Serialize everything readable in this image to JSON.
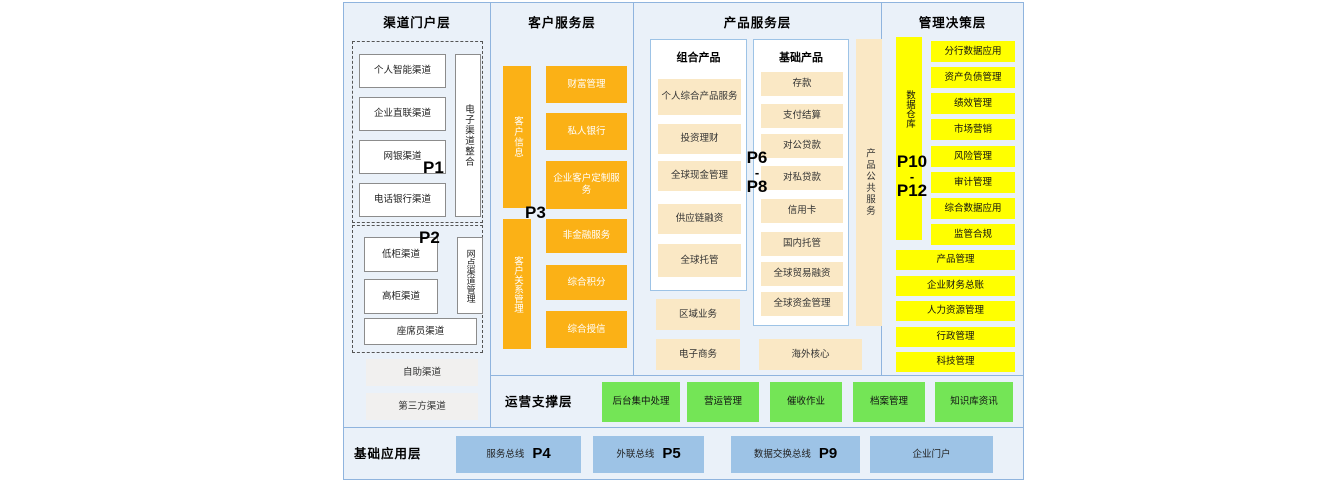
{
  "colors": {
    "panel_bg": "#EAF1F9",
    "border_blue": "#8FB4DE",
    "orange": "#FBB116",
    "cream": "#FAE8C5",
    "yellow": "#FFFF00",
    "green": "#74E556",
    "blue": "#9DC3E6"
  },
  "channel": {
    "title": "渠道门户层",
    "p1": "P1",
    "p2": "P2",
    "group1": [
      "个人智能渠道",
      "企业直联渠道",
      "网银渠道",
      "电话银行渠道"
    ],
    "group1_vertical": "电子渠道整合",
    "group2": [
      "低柜渠道",
      "高柜渠道"
    ],
    "group2_vertical": "网点渠道管理",
    "group2_wide": "座席员渠道",
    "extras": [
      "自助渠道",
      "第三方渠道"
    ]
  },
  "customer": {
    "title": "客户服务层",
    "p3": "P3",
    "upper_vertical": "客户信息",
    "upper": [
      "财富管理",
      "私人银行",
      "企业客户定制服务"
    ],
    "lower_vertical": "客户关系管理",
    "lower": [
      "非金融服务",
      "综合积分",
      "综合授信"
    ]
  },
  "product": {
    "title": "产品服务层",
    "p_top": "P6",
    "p_sep": "-",
    "p_bottom": "P8",
    "combo_title": "组合产品",
    "combo": [
      "个人综合产品服务",
      "投资理财",
      "全球现金管理",
      "供应链融资",
      "全球托管"
    ],
    "basic_title": "基础产品",
    "basic": [
      "存款",
      "支付结算",
      "对公贷款",
      "对私贷款",
      "信用卡",
      "国内托管",
      "全球贸易融资",
      "全球资金管理"
    ],
    "vertical": "产品公共服务",
    "extras_left": [
      "区域业务",
      "电子商务"
    ],
    "extra_right": "海外核心"
  },
  "management": {
    "title": "管理决策层",
    "p_top": "P10",
    "p_sep": "-",
    "p_bottom": "P12",
    "vertical": "数据仓库",
    "right": [
      "分行数据应用",
      "资产负债管理",
      "绩效管理",
      "市场营销",
      "风险管理",
      "审计管理",
      "综合数据应用",
      "监管合规"
    ],
    "wide": [
      "产品管理",
      "企业财务总账",
      "人力资源管理",
      "行政管理",
      "科技管理"
    ]
  },
  "operations": {
    "title": "运营支撑层",
    "items": [
      "后台集中处理",
      "营运管理",
      "催收作业",
      "档案管理",
      "知识库资讯"
    ]
  },
  "foundation": {
    "title": "基础应用层",
    "items": [
      {
        "label": "服务总线",
        "p": "P4"
      },
      {
        "label": "外联总线",
        "p": "P5"
      },
      {
        "label": "数据交换总线",
        "p": "P9"
      },
      {
        "label": "企业门户",
        "p": ""
      }
    ]
  }
}
